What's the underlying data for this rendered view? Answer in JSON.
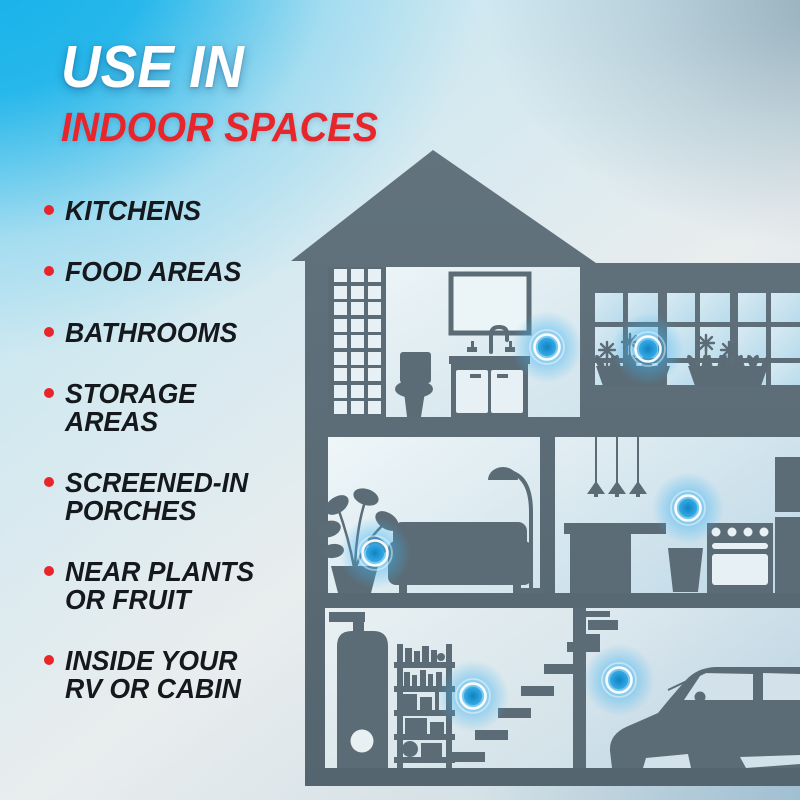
{
  "header": {
    "title": "USE IN",
    "subtitle": "INDOOR SPACES"
  },
  "list": {
    "items": [
      {
        "label": "KITCHENS"
      },
      {
        "label": "FOOD AREAS"
      },
      {
        "label": "BATHROOMS"
      },
      {
        "label": "STORAGE\nAREAS"
      },
      {
        "label": "SCREENED-IN\nPORCHES"
      },
      {
        "label": "NEAR PLANTS\nOR FRUIT"
      },
      {
        "label": "INSIDE YOUR\nRV OR CABIN"
      }
    ]
  },
  "illustration": {
    "type": "house-cutaway-silhouette",
    "placement_markers": [
      "bathroom",
      "window-planters",
      "living-room",
      "kitchen",
      "basement",
      "garage"
    ]
  },
  "colors": {
    "accent_red": "#e8252b",
    "title_white": "#ffffff",
    "list_text": "#15181c",
    "background_cyan": "#14b2ea",
    "house_gray_blue": "#5b6c76",
    "room_light": "#e7f1f5",
    "glow_blue": "#2ba7e4",
    "dot_core_blue": "#0f82c4"
  }
}
